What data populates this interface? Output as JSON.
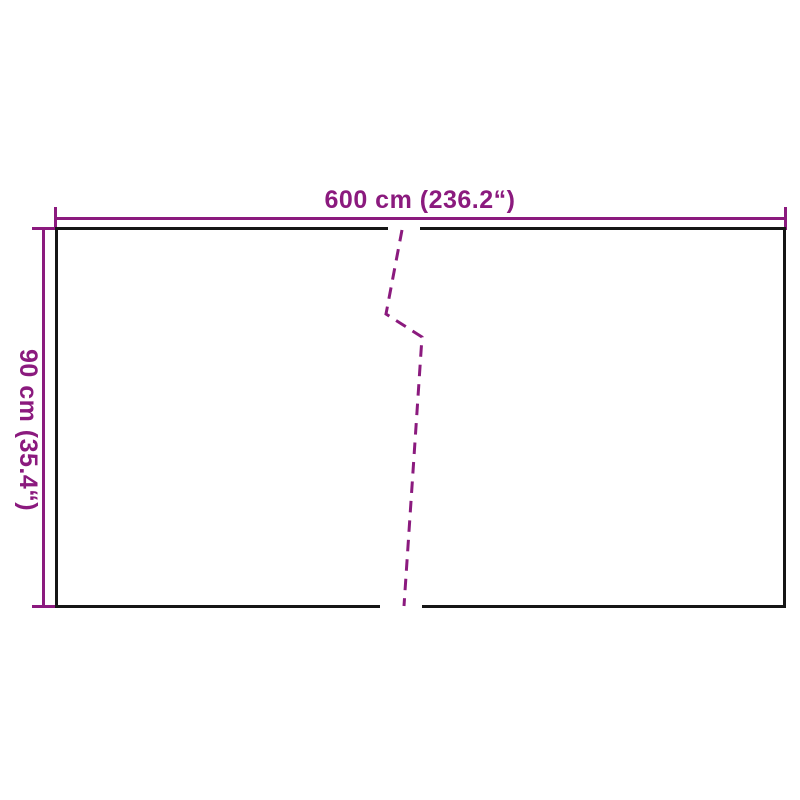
{
  "diagram": {
    "kind": "product-dimension-diagram",
    "width_label": "600 cm (236.2“)",
    "height_label": "90 cm (35.4“)",
    "width_value_cm": 600,
    "width_value_inches": 236.2,
    "height_value_cm": 90,
    "height_value_inches": 35.4,
    "colors": {
      "dimension_accent": "#8B1A7E",
      "outline": "#161616",
      "background": "#FFFFFF"
    }
  }
}
